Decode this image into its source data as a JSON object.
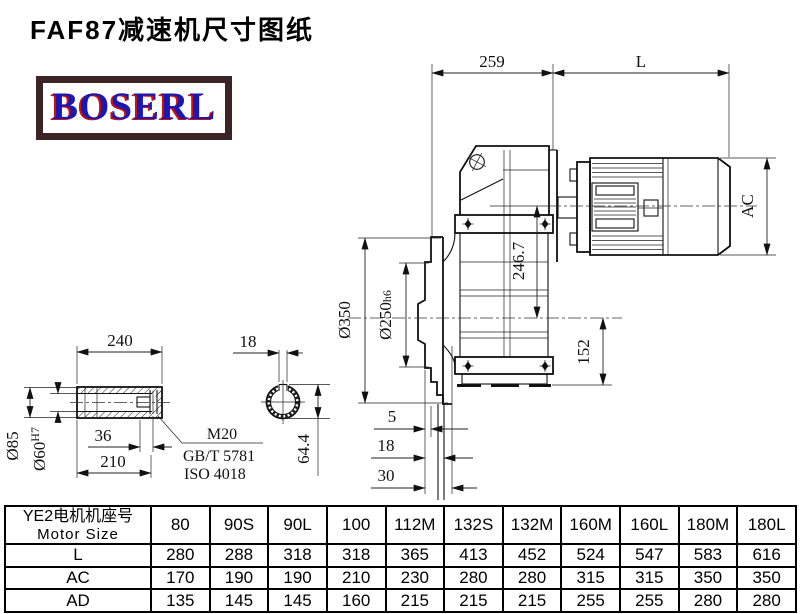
{
  "page": {
    "title": "FAF87减速机尺寸图纸",
    "logo": "BOSERL"
  },
  "drawing": {
    "dims": {
      "span_259": "259",
      "motor_len": "L",
      "motor_dia": "AC",
      "flange_od": "Ø350",
      "spigot_od": "Ø250",
      "spigot_fit": "h6",
      "input_height": "246.7",
      "base_height": "152",
      "step_5": "5",
      "step_18": "18",
      "step_30": "30",
      "sleeve_len": "240",
      "sleeve_od": "Ø85",
      "bore": "Ø60",
      "bore_fit": "H7",
      "recess_36": "36",
      "bore_len": "210",
      "bolt": "M20",
      "bolt_gb": "GB/T 5781",
      "bolt_iso": "ISO 4018",
      "key_w": "18",
      "key_h": "64.4"
    }
  },
  "table": {
    "header_cn": "YE2电机机座号",
    "header_en": "Motor Size",
    "columns": [
      "80",
      "90S",
      "90L",
      "100",
      "112M",
      "132S",
      "132M",
      "160M",
      "160L",
      "180M",
      "180L"
    ],
    "rows": [
      {
        "label": "L",
        "values": [
          "280",
          "288",
          "318",
          "318",
          "365",
          "413",
          "452",
          "524",
          "547",
          "583",
          "616"
        ]
      },
      {
        "label": "AC",
        "values": [
          "170",
          "190",
          "190",
          "210",
          "230",
          "280",
          "280",
          "315",
          "315",
          "350",
          "350"
        ]
      },
      {
        "label": "AD",
        "values": [
          "135",
          "145",
          "145",
          "160",
          "215",
          "215",
          "215",
          "255",
          "255",
          "280",
          "280"
        ]
      }
    ]
  }
}
